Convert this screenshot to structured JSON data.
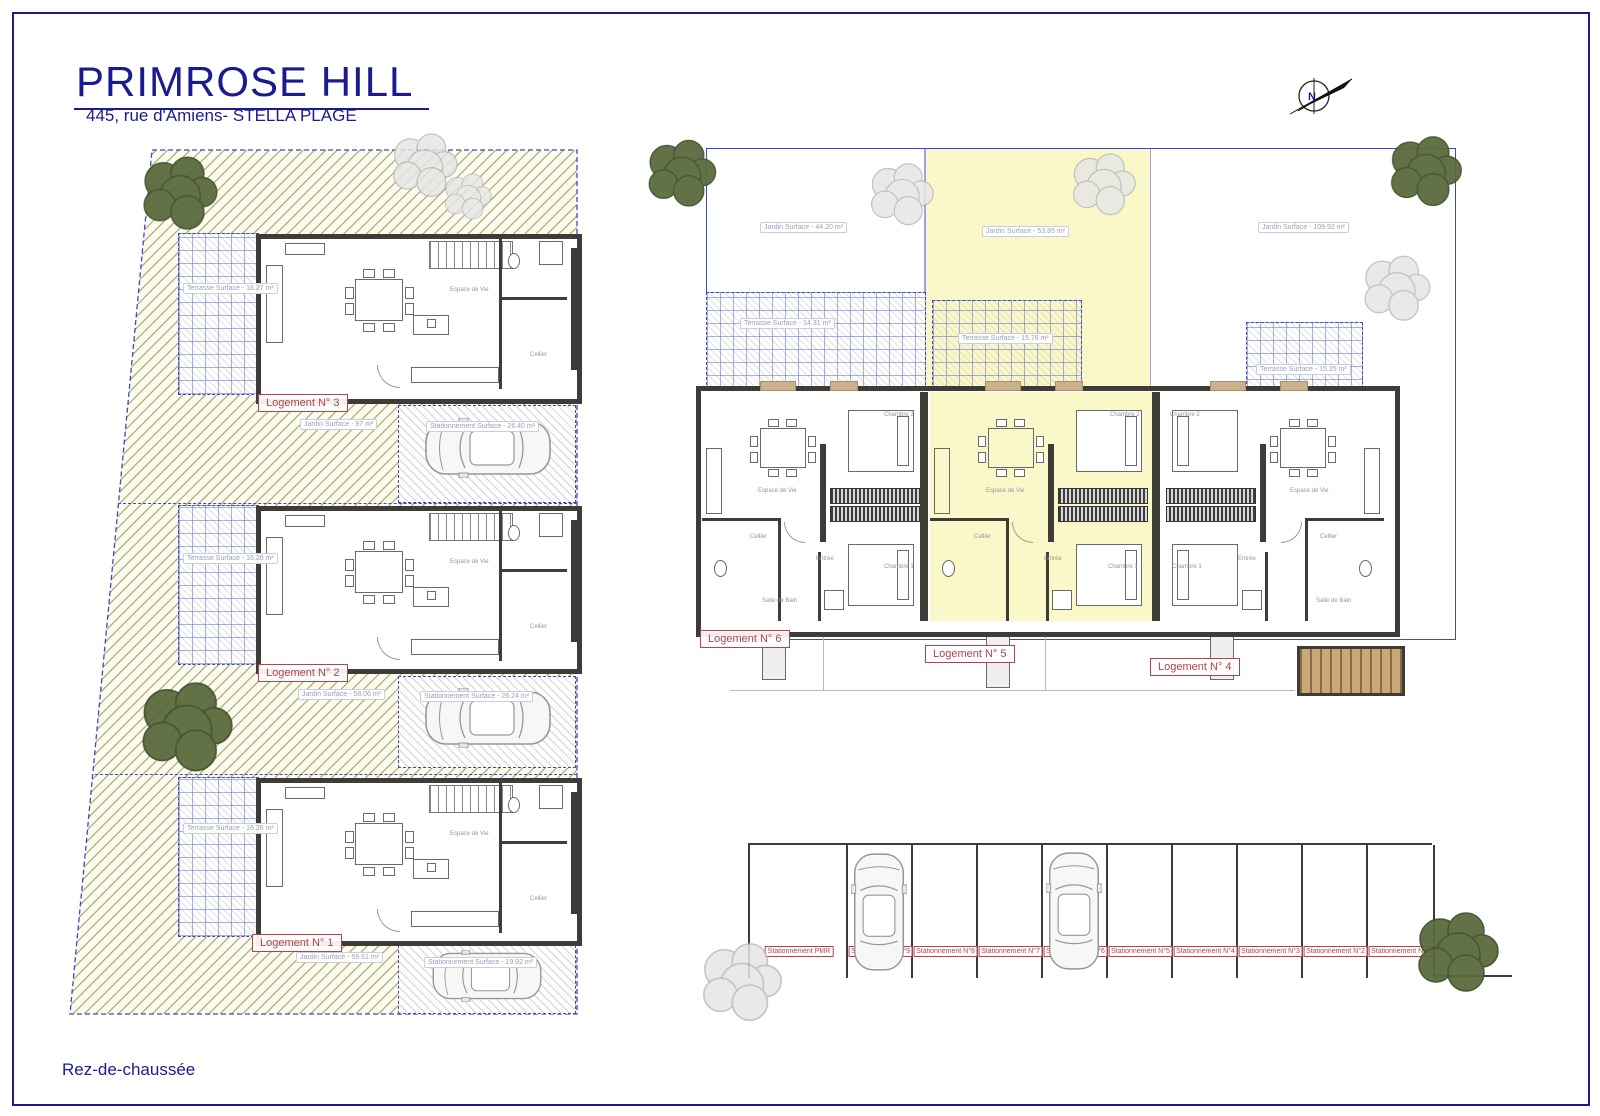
{
  "title": "PRIMROSE HILL",
  "subtitle": "445, rue d'Amiens- STELLA PLAGE",
  "floor_label": "Rez-de-chaussée",
  "north": {
    "label": "N"
  },
  "colors": {
    "navy": "#1b1b8f",
    "label_red": "#b5424c",
    "parcel_blue": "#3b49c8",
    "hatch_olive": "#a5a356",
    "wall_dark": "#3f3c38",
    "highlight_yellow": "#faf7c9",
    "wood_tan": "#c9a97a",
    "tree_green": "#5b6a3d",
    "tree_gray": "#e3e3e3"
  },
  "rooms": {
    "living": "Espace de Vie",
    "cellier": "Cellier",
    "entree": "Entrée",
    "chambre1": "Chambre 1",
    "chambre2": "Chambre 2",
    "salle_de_bain": "Salle de Bain",
    "wc": "WC"
  },
  "left_site": {
    "units": [
      {
        "label": "Logement N° 3",
        "terrasse": "Terrasse Surface - 16.27 m²",
        "jardin": "Jardin Surface - 97 m²",
        "stationnement": "Stationnement Surface - 26.40 m²"
      },
      {
        "label": "Logement N° 2",
        "terrasse": "Terrasse Surface - 16.26 m²",
        "jardin": "Jardin Surface - 58.06 m²",
        "stationnement": "Stationnement Surface - 26.24 m²"
      },
      {
        "label": "Logement N° 1",
        "terrasse": "Terrasse Surface - 16.26 m²",
        "jardin": "Jardin Surface - 59.61 m²",
        "stationnement": "Stationnement Surface - 19.92 m²"
      }
    ]
  },
  "right_site": {
    "jardins": [
      "Jardin Surface - 44.20 m²",
      "Jardin Surface - 53.85 m²",
      "Jardin Surface - 109.92 m²"
    ],
    "terrasses": [
      "Terrasse Surface - 14.31 m²",
      "Terrasse Surface - 15.76 m²",
      "Terrasse Surface - 15.25 m²"
    ],
    "units": [
      {
        "label": "Logement N° 6"
      },
      {
        "label": "Logement N° 5"
      },
      {
        "label": "Logement N° 4"
      }
    ]
  },
  "parking": {
    "stalls": [
      {
        "label": "Stationnement PMR"
      },
      {
        "label": "Stationnement N°9"
      },
      {
        "label": "Stationnement N°8"
      },
      {
        "label": "Stationnement N°7"
      },
      {
        "label": "Stationnement N°6"
      },
      {
        "label": "Stationnement N°5"
      },
      {
        "label": "Stationnement N°4"
      },
      {
        "label": "Stationnement N°3"
      },
      {
        "label": "Stationnement N°2"
      },
      {
        "label": "Stationnement N°1"
      }
    ]
  }
}
